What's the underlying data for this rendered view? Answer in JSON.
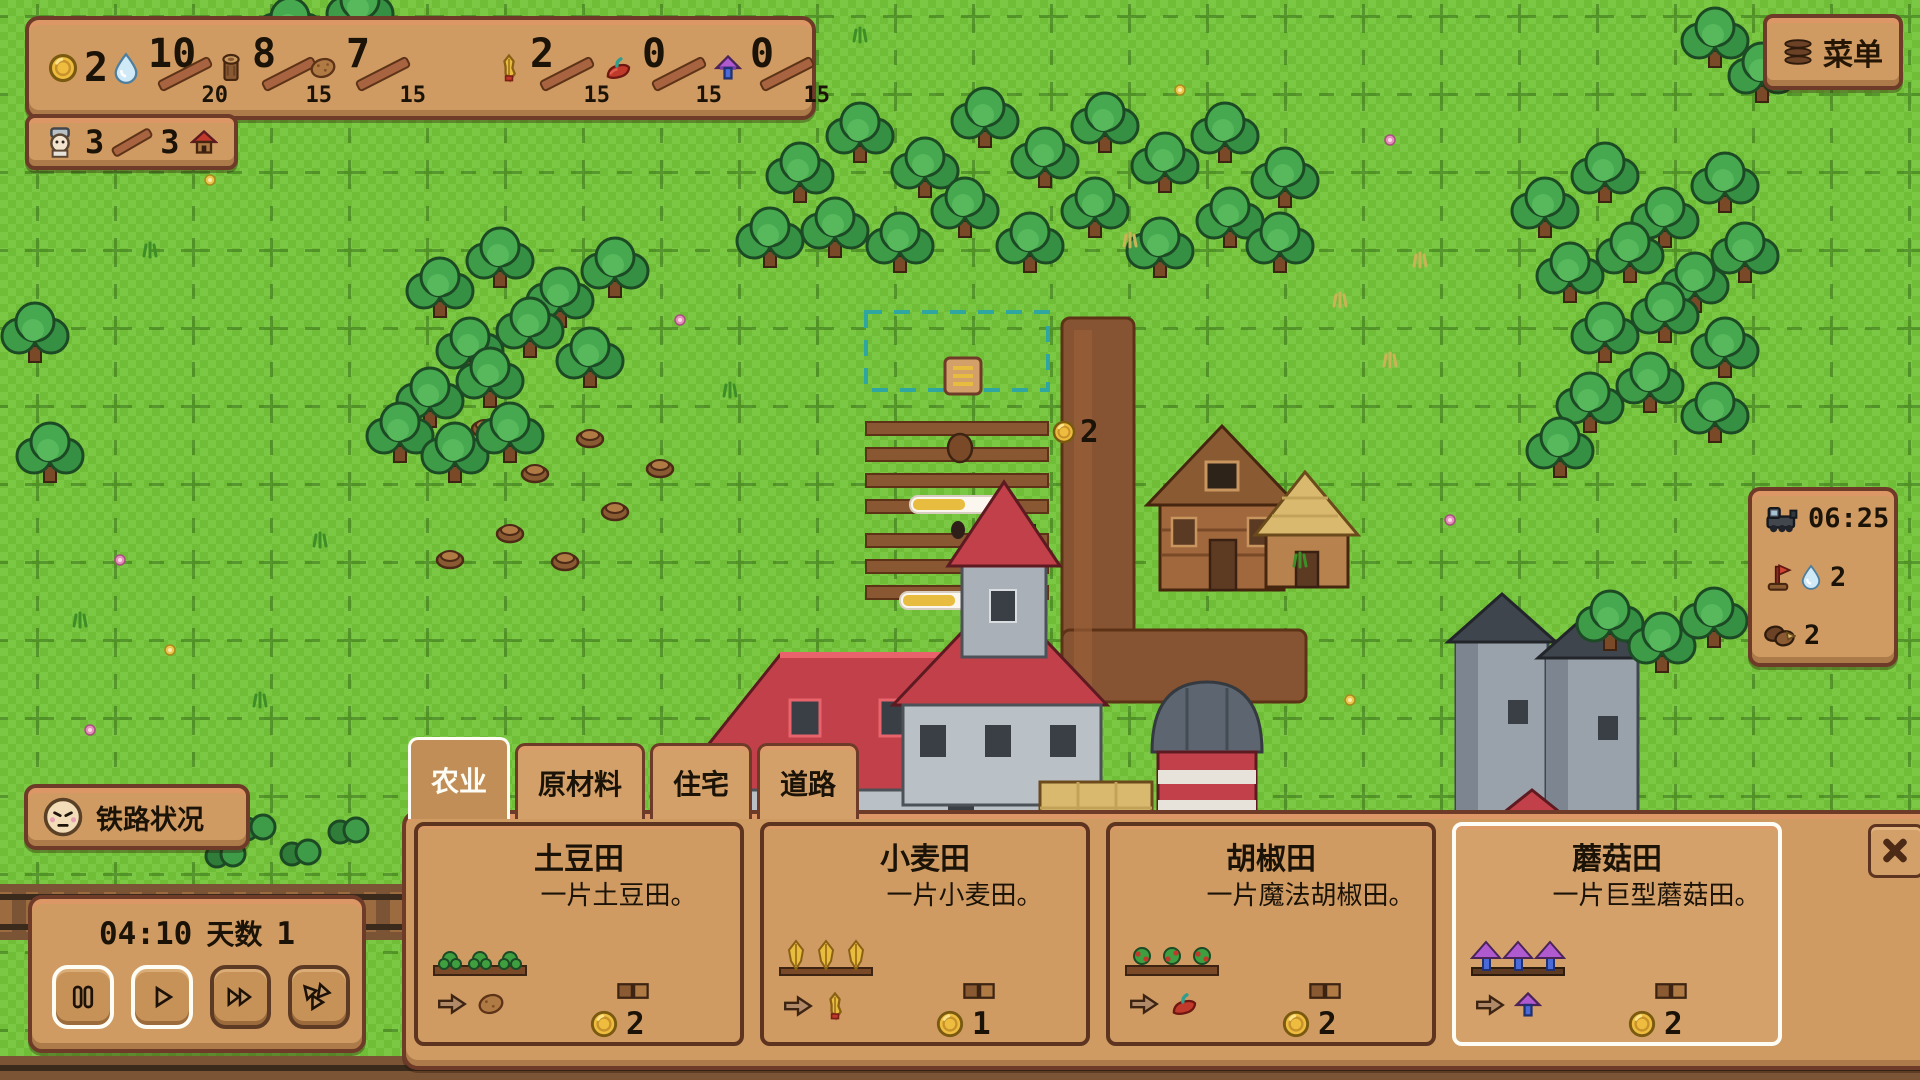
{
  "colors": {
    "panel": "#cf9b62",
    "panel_border": "#6e3b28",
    "accent_gold": "#e8bc3f",
    "grass": "#74c13c",
    "selected_border": "#fdfdf5"
  },
  "resources_bar": {
    "items": [
      {
        "name": "coins",
        "icon": "coin-icon",
        "value": "2",
        "max": ""
      },
      {
        "name": "water",
        "icon": "water-icon",
        "value": "10",
        "max": "20"
      },
      {
        "name": "wood",
        "icon": "log-icon",
        "value": "8",
        "max": "15"
      },
      {
        "name": "potatoes",
        "icon": "potato-icon",
        "value": "7",
        "max": "15"
      },
      {
        "name": "wheat",
        "icon": "wheat-icon",
        "value": "2",
        "max": "15"
      },
      {
        "name": "peppers",
        "icon": "pepper-icon",
        "value": "0",
        "max": "15"
      },
      {
        "name": "mushrooms",
        "icon": "mushroom-icon",
        "value": "0",
        "max": "15"
      }
    ]
  },
  "population_badge": {
    "current": "3",
    "max": "3"
  },
  "menu_button": {
    "label": "菜单"
  },
  "map_overlay": {
    "floating_coin_value": "2"
  },
  "train_status_panel": {
    "arrival_time": "06:25",
    "water_needed": "2",
    "wood_needed": "2"
  },
  "railway_status_button": {
    "label": "铁路状况"
  },
  "time_panel": {
    "clock": "04:10",
    "day_label": "天数",
    "day_number": "1"
  },
  "build_panel": {
    "tabs": [
      {
        "label": "农业",
        "active": true
      },
      {
        "label": "原材料",
        "active": false
      },
      {
        "label": "住宅",
        "active": false
      },
      {
        "label": "道路",
        "active": false
      }
    ],
    "cards": [
      {
        "title": "土豆田",
        "description": "一片土豆田。",
        "produces": "potato",
        "cost": "2",
        "selected": false
      },
      {
        "title": "小麦田",
        "description": "一片小麦田。",
        "produces": "wheat",
        "cost": "1",
        "selected": false
      },
      {
        "title": "胡椒田",
        "description": "一片魔法胡椒田。",
        "produces": "pepper",
        "cost": "2",
        "selected": false
      },
      {
        "title": "蘑菇田",
        "description": "一片巨型蘑菇田。",
        "produces": "mushroom",
        "cost": "2",
        "selected": true
      }
    ]
  }
}
